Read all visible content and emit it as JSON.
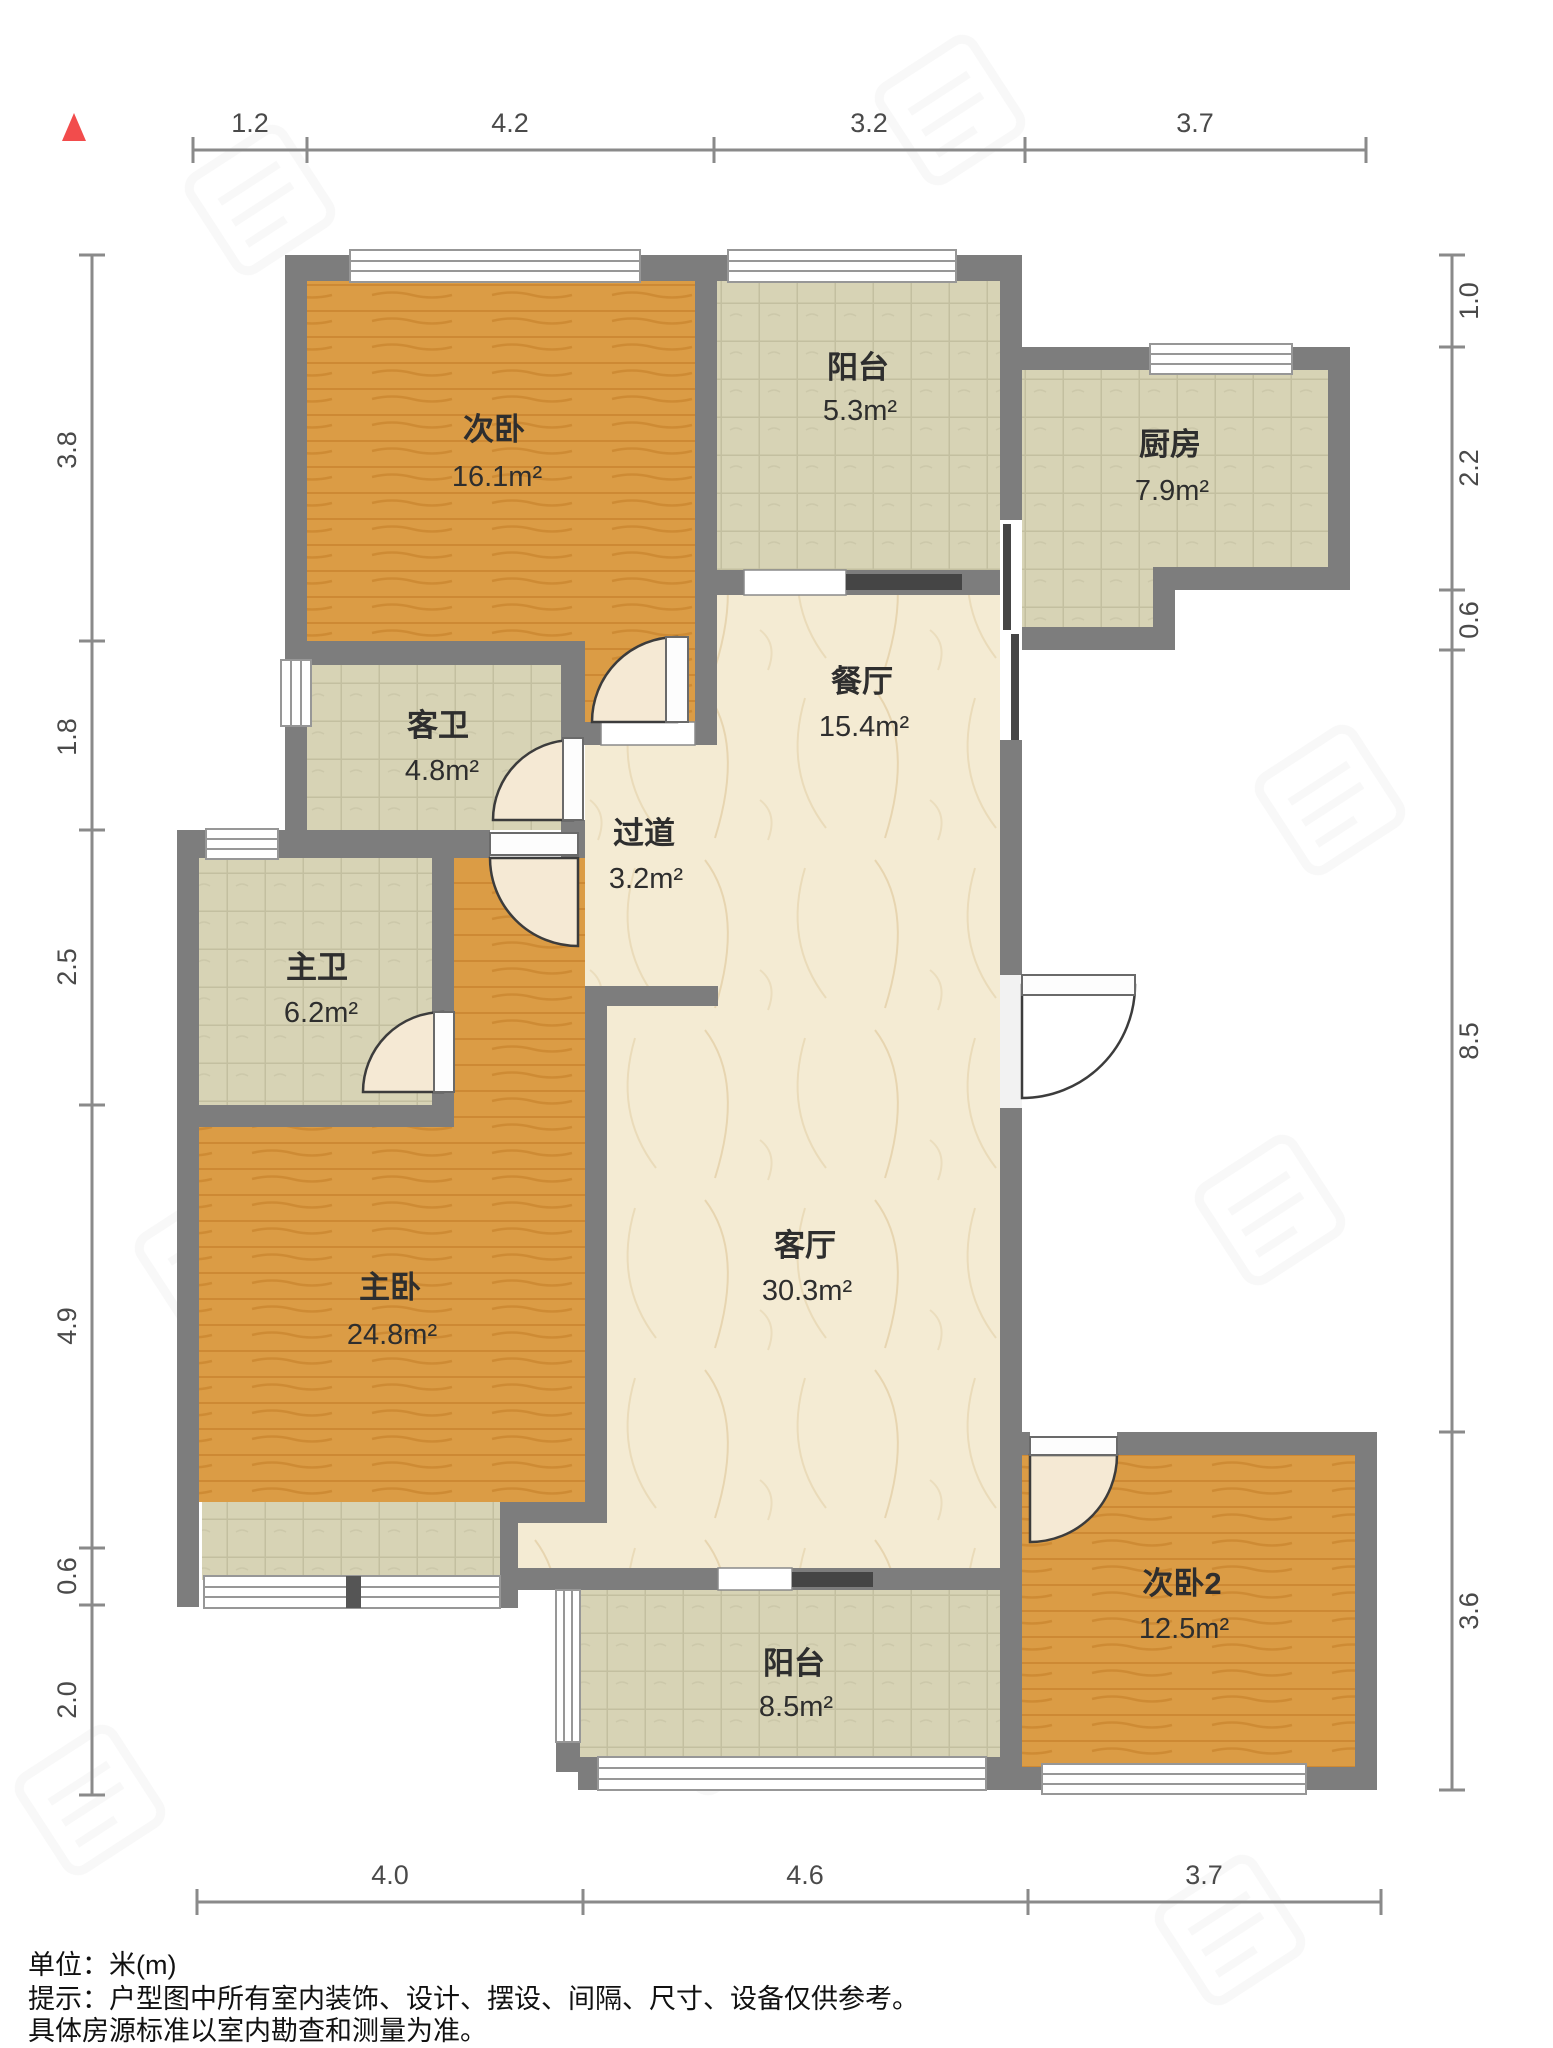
{
  "floorplan": {
    "north_marker_color": "#F24C4C",
    "rooms": [
      {
        "id": "cewo",
        "name": "次卧",
        "area": "16.1m²"
      },
      {
        "id": "yangtai-top",
        "name": "阳台",
        "area": "5.3m²"
      },
      {
        "id": "chufang",
        "name": "厨房",
        "area": "7.9m²"
      },
      {
        "id": "canting",
        "name": "餐厅",
        "area": "15.4m²"
      },
      {
        "id": "kewei",
        "name": "客卫",
        "area": "4.8m²"
      },
      {
        "id": "guodao",
        "name": "过道",
        "area": "3.2m²"
      },
      {
        "id": "zhuwei",
        "name": "主卫",
        "area": "6.2m²"
      },
      {
        "id": "zhuwo",
        "name": "主卧",
        "area": "24.8m²"
      },
      {
        "id": "keting",
        "name": "客厅",
        "area": "30.3m²"
      },
      {
        "id": "yangtai-bottom",
        "name": "阳台",
        "area": "8.5m²"
      },
      {
        "id": "cewo2",
        "name": "次卧2",
        "area": "12.5m²"
      }
    ],
    "dimensions": {
      "top": [
        "1.2",
        "4.2",
        "3.2",
        "3.7"
      ],
      "bottom": [
        "4.0",
        "4.6",
        "3.7"
      ],
      "left": [
        "3.8",
        "1.8",
        "2.5",
        "4.9",
        "0.6",
        "2.0"
      ],
      "right": [
        "1.0",
        "2.2",
        "0.6",
        "8.5",
        "3.6"
      ]
    }
  },
  "footer": {
    "unit_label": "单位：米(m)",
    "tip_line1": "提示：户型图中所有室内装饰、设计、摆设、间隔、尺寸、设备仅供参考。",
    "tip_line2": "具体房源标准以室内勘查和测量为准。"
  }
}
